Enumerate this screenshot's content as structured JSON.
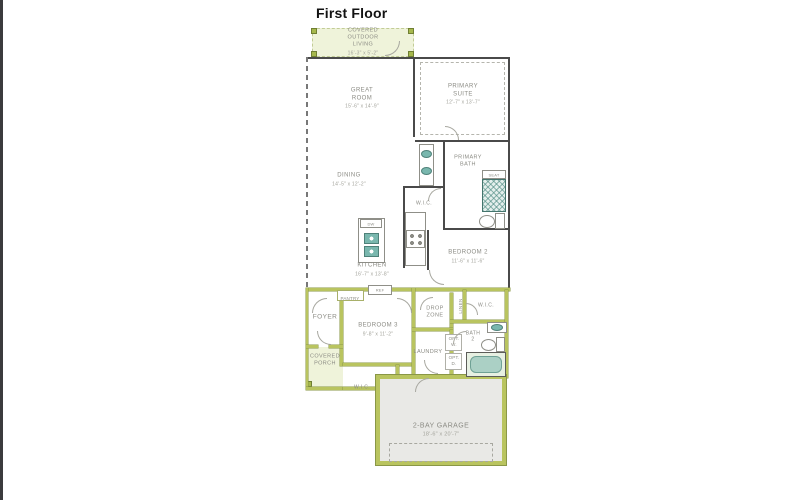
{
  "title": "First Floor",
  "rooms": {
    "covered_outdoor_living": {
      "label": "COVERED\nOUTDOOR\nLIVING",
      "dims": "16'-3\" x 5'-2\""
    },
    "great_room": {
      "label": "GREAT\nROOM",
      "dims": "15'-6\" x 14'-9\""
    },
    "primary_suite": {
      "label": "PRIMARY\nSUITE",
      "dims": "12'-7\" x 13'-7\""
    },
    "primary_bath": {
      "label": "PRIMARY\nBATH"
    },
    "wic_primary": {
      "label": "W.I.C."
    },
    "dining": {
      "label": "DINING",
      "dims": "14'-5\" x 12'-2\""
    },
    "kitchen": {
      "label": "KITCHEN",
      "dims": "16'-7\" x 13'-8\""
    },
    "bedroom_2": {
      "label": "BEDROOM 2",
      "dims": "11'-6\" x 11'-6\""
    },
    "pantry": {
      "label": "PANTRY"
    },
    "foyer": {
      "label": "FOYER"
    },
    "bedroom_3": {
      "label": "BEDROOM 3",
      "dims": "9'-8\" x 11'-2\""
    },
    "drop_zone": {
      "label": "DROP\nZONE"
    },
    "linen": {
      "label": "LINEN"
    },
    "wic_bedroom2": {
      "label": "W.I.C."
    },
    "bath_2": {
      "label": "BATH\n2"
    },
    "laundry": {
      "label": "LAUNDRY"
    },
    "covered_porch": {
      "label": "COVERED\nPORCH"
    },
    "wic_bedroom3": {
      "label": "W.I.C."
    },
    "garage": {
      "label": "2-BAY GARAGE",
      "dims": "18'-6\" x 20'-7\""
    }
  },
  "fixtures": {
    "dishwasher": "DW",
    "refrigerator": "REF",
    "shower_seat": "SEAT",
    "opt_washer": "OPT.\nW.",
    "opt_dryer": "OPT.\nD."
  },
  "colors": {
    "wall_dark": "#4a4a4a",
    "wall_lime": "#b9c45f",
    "area_light_green": "#eff3da",
    "garage_floor": "#e9e9e6",
    "fixture_teal": "#79b7ae",
    "label_gray": "#8b8b84",
    "title_black": "#121212"
  }
}
